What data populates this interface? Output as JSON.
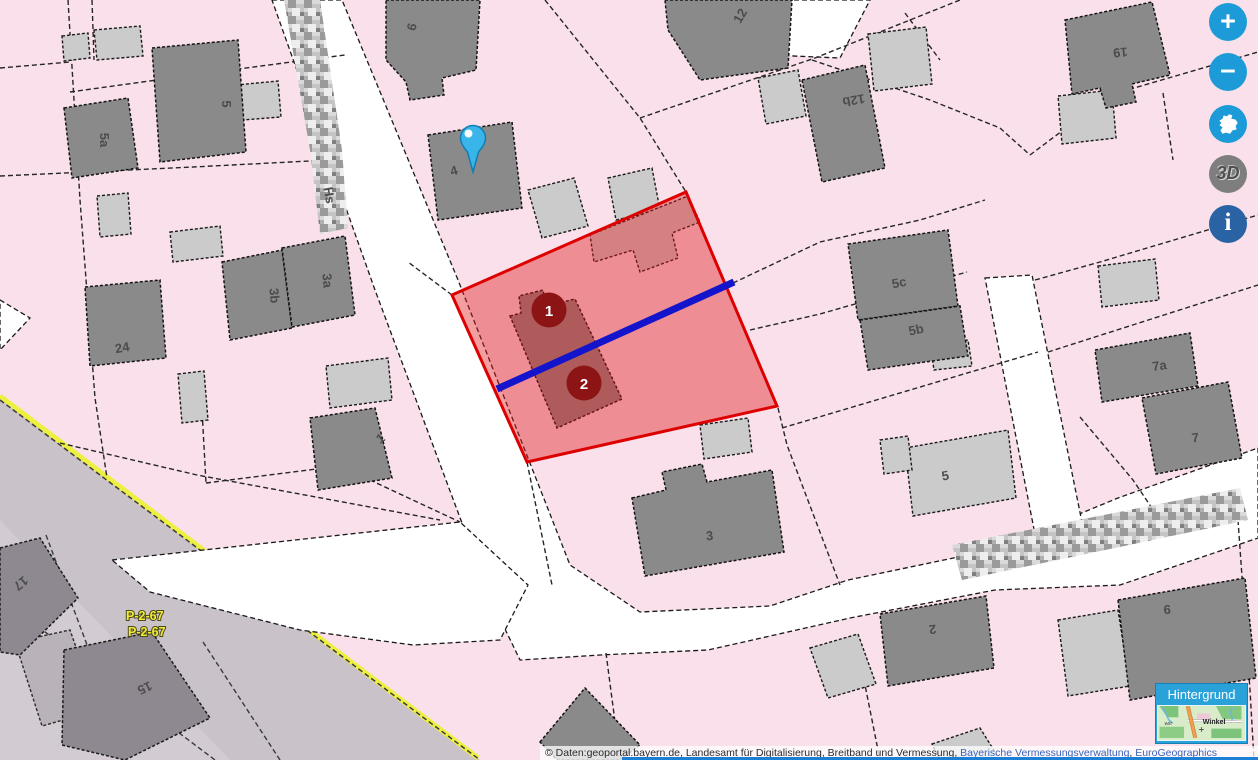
{
  "map_controls": {
    "zoom_in_label": "+",
    "zoom_out_label": "−",
    "full_extent_icon": "bavaria-outline",
    "view_3d_label": "3D",
    "info_label": "i"
  },
  "background_selector": {
    "title": "Hintergrund",
    "thumb_place": "Winkel",
    "thumb_place_small": "Wkt"
  },
  "attribution": {
    "prefix": "© Daten:geoportal.bayern.de, Landesamt für Digitalisierung, Breitband und Vermessung, ",
    "link_vermessung": "Bayerische Vermessungsverwaltung",
    "separator": ", ",
    "link_euro": "EuroGeographics"
  },
  "measurement": {
    "marker_1": "1",
    "marker_2": "2"
  },
  "parcel_annotation": {
    "line1": "P-2-67",
    "line2": "P-2-67"
  },
  "street_label_fragment": "Hs",
  "house_numbers": {
    "h5a": "5a",
    "h5": "5",
    "h24": "24",
    "h3b": "3b",
    "h3a": "3a",
    "h4": "4",
    "h6": "6",
    "h1": "1",
    "h12": "12",
    "h12b": "12b",
    "h19": "19",
    "h5c": "5c",
    "h5b": "5b",
    "h7a": "7a",
    "h7": "7",
    "h3": "3",
    "h5s": "5",
    "h2": "2",
    "h9": "9",
    "h17": "17",
    "h15": "15"
  },
  "colors": {
    "parcel_pink": "#f9e0ea",
    "zone_gray": "#c9c2c9",
    "building_dark": "#8a8a8a",
    "building_light": "#cbcbcb",
    "street_white": "#ffffff",
    "boundary_yellow": "#eef040",
    "selection_fill_rgba": "rgba(227,26,28,0.42)",
    "selection_stroke": "#dd0000",
    "measure_blue": "#1414cc",
    "marker_red": "#8c1414",
    "pin_blue": "#3ab5ea",
    "control_blue": "#1d9bd8",
    "info_blue": "#2a63a4",
    "gray_3d": "#7e7e7e",
    "panel_blue": "#29a2da"
  }
}
